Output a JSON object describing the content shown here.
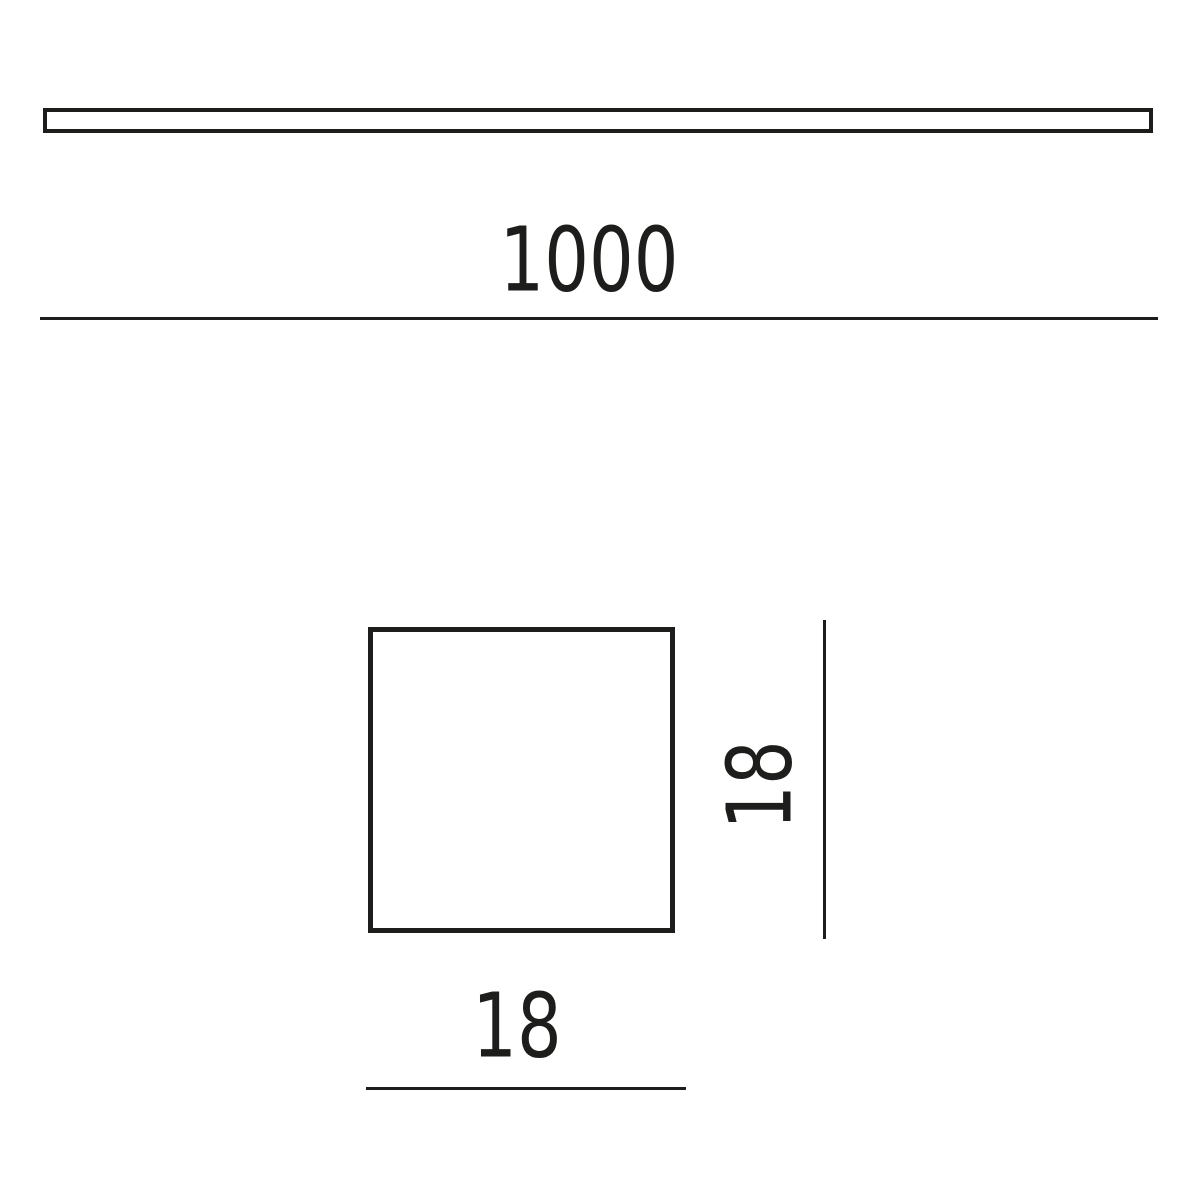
{
  "colors": {
    "line": "#1d1d1b",
    "background": "#ffffff"
  },
  "drawing": {
    "type": "technical-dimension-drawing",
    "views": [
      {
        "name": "profile-side-view",
        "shape": "long-thin-rectangle-outline"
      },
      {
        "name": "profile-cross-section",
        "shape": "square-outline"
      }
    ],
    "dimensions": {
      "length": {
        "label": "1000",
        "orientation": "horizontal"
      },
      "width": {
        "label": "18",
        "orientation": "horizontal"
      },
      "height": {
        "label": "18",
        "orientation": "vertical"
      }
    }
  }
}
